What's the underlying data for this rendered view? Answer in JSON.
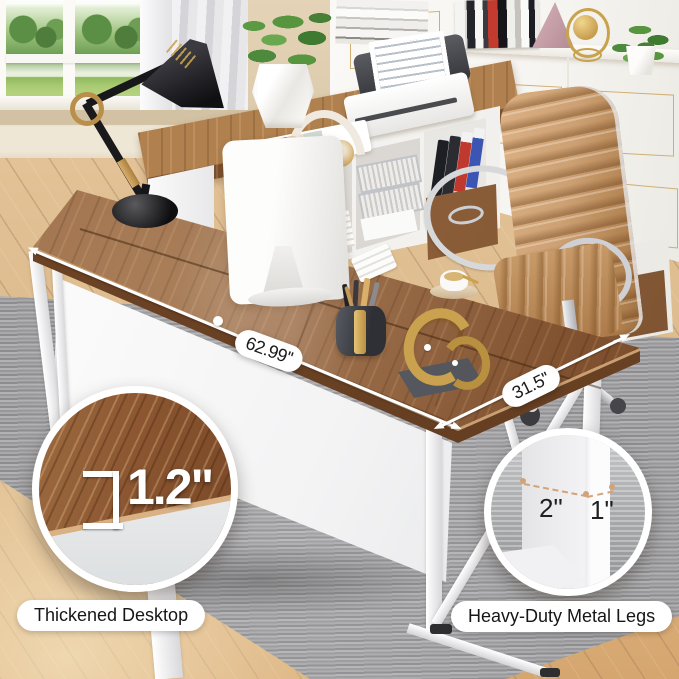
{
  "product_annotations": {
    "desk_length": "62.99''",
    "desk_depth": "31.5''",
    "desktop_thickness": "1.2\"",
    "leg_width": "2\"",
    "leg_depth": "1\"",
    "feature_left": "Thickened Desktop",
    "feature_right": "Heavy-Duty Metal Legs"
  },
  "colors": {
    "wall": "#d8c5a6",
    "baseboard": "#efe7d6",
    "floor": "#dcba8c",
    "rug-light": "#b2b2b4",
    "cabinet": "#f7f5f1",
    "gold-trim": "#cfae72",
    "desk-top": "#8d5c38",
    "desk-top-light": "#b0804f",
    "desk-edge": "#744728",
    "chair": "#cda173",
    "chrome": "#d7d8da",
    "brass": "#c9a24e",
    "annotation-ink": "#1b1c1e"
  }
}
